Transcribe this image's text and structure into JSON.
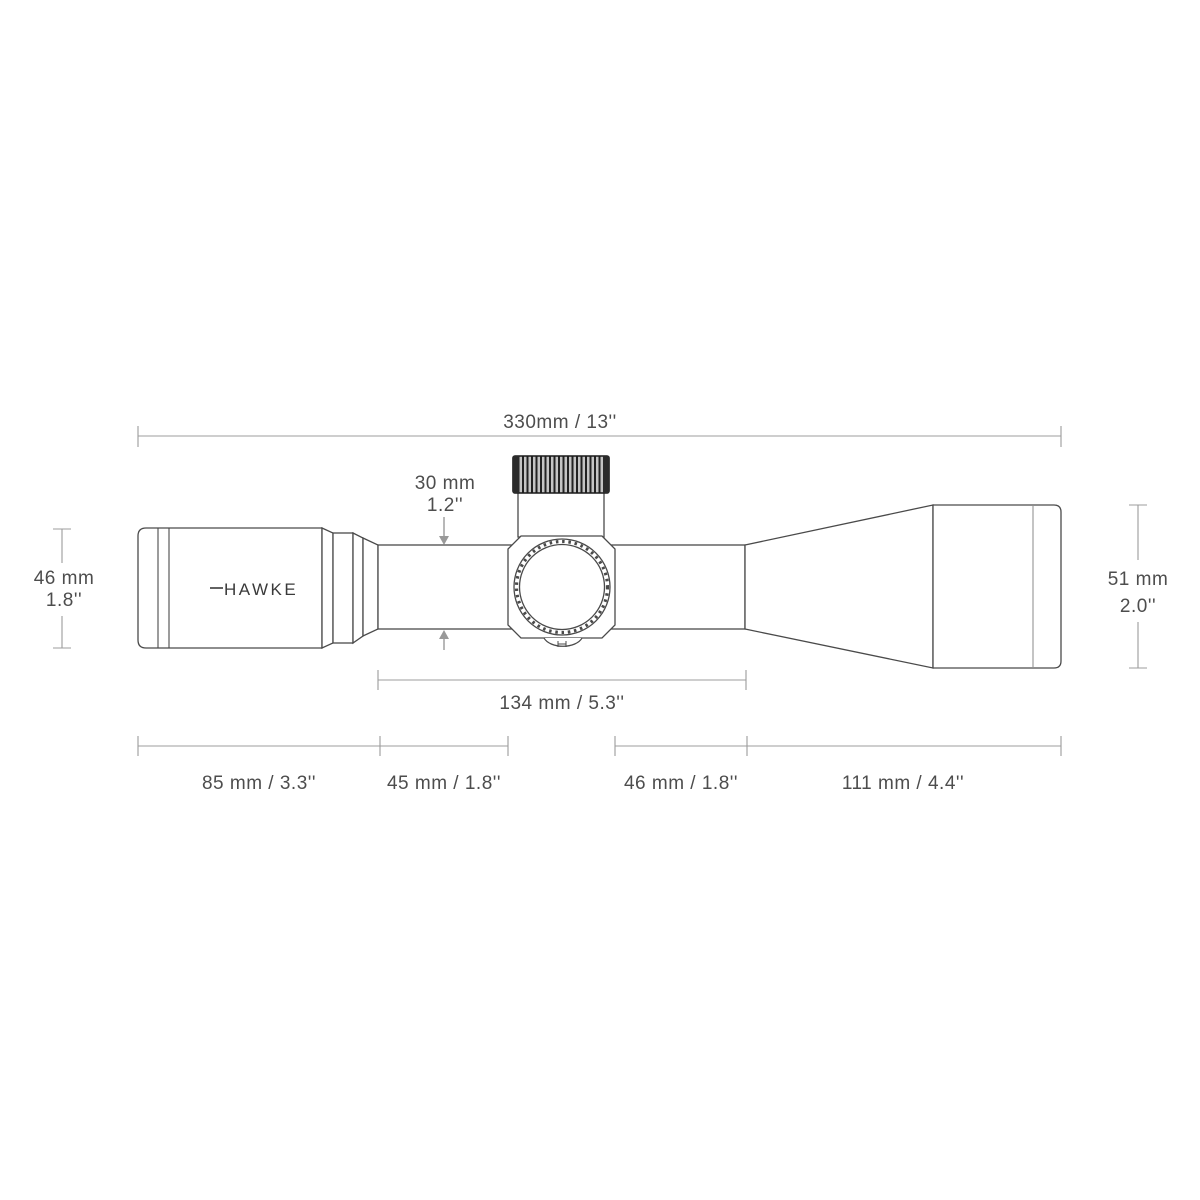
{
  "title": "Riflescope dimensions technical diagram",
  "brand": {
    "logo": "HAWKE"
  },
  "colors": {
    "outline": "#4a4a4a",
    "dimension_line": "#9c9c9c",
    "arrow": "#999999",
    "label_text": "#4d4d4d",
    "turret_knurl_dark": "#222222",
    "turret_knurl_light": "#c4c4c4",
    "background": "#ffffff"
  },
  "dimensions": {
    "overall_length": "330mm / 13''",
    "tube_diameter": {
      "line1": "30 mm",
      "line2": "1.2''"
    },
    "eyepiece_diameter": {
      "line1": "46 mm",
      "line2": "1.8''"
    },
    "objective_diameter": {
      "line1": "51 mm",
      "line2": "2.0''"
    },
    "mounting_length": "134 mm / 5.3''",
    "eyepiece_length": "85 mm / 3.3''",
    "rear_tube_length": "45 mm / 1.8''",
    "front_tube_length": "46 mm / 1.8''",
    "objective_length": "111 mm / 4.4''"
  }
}
